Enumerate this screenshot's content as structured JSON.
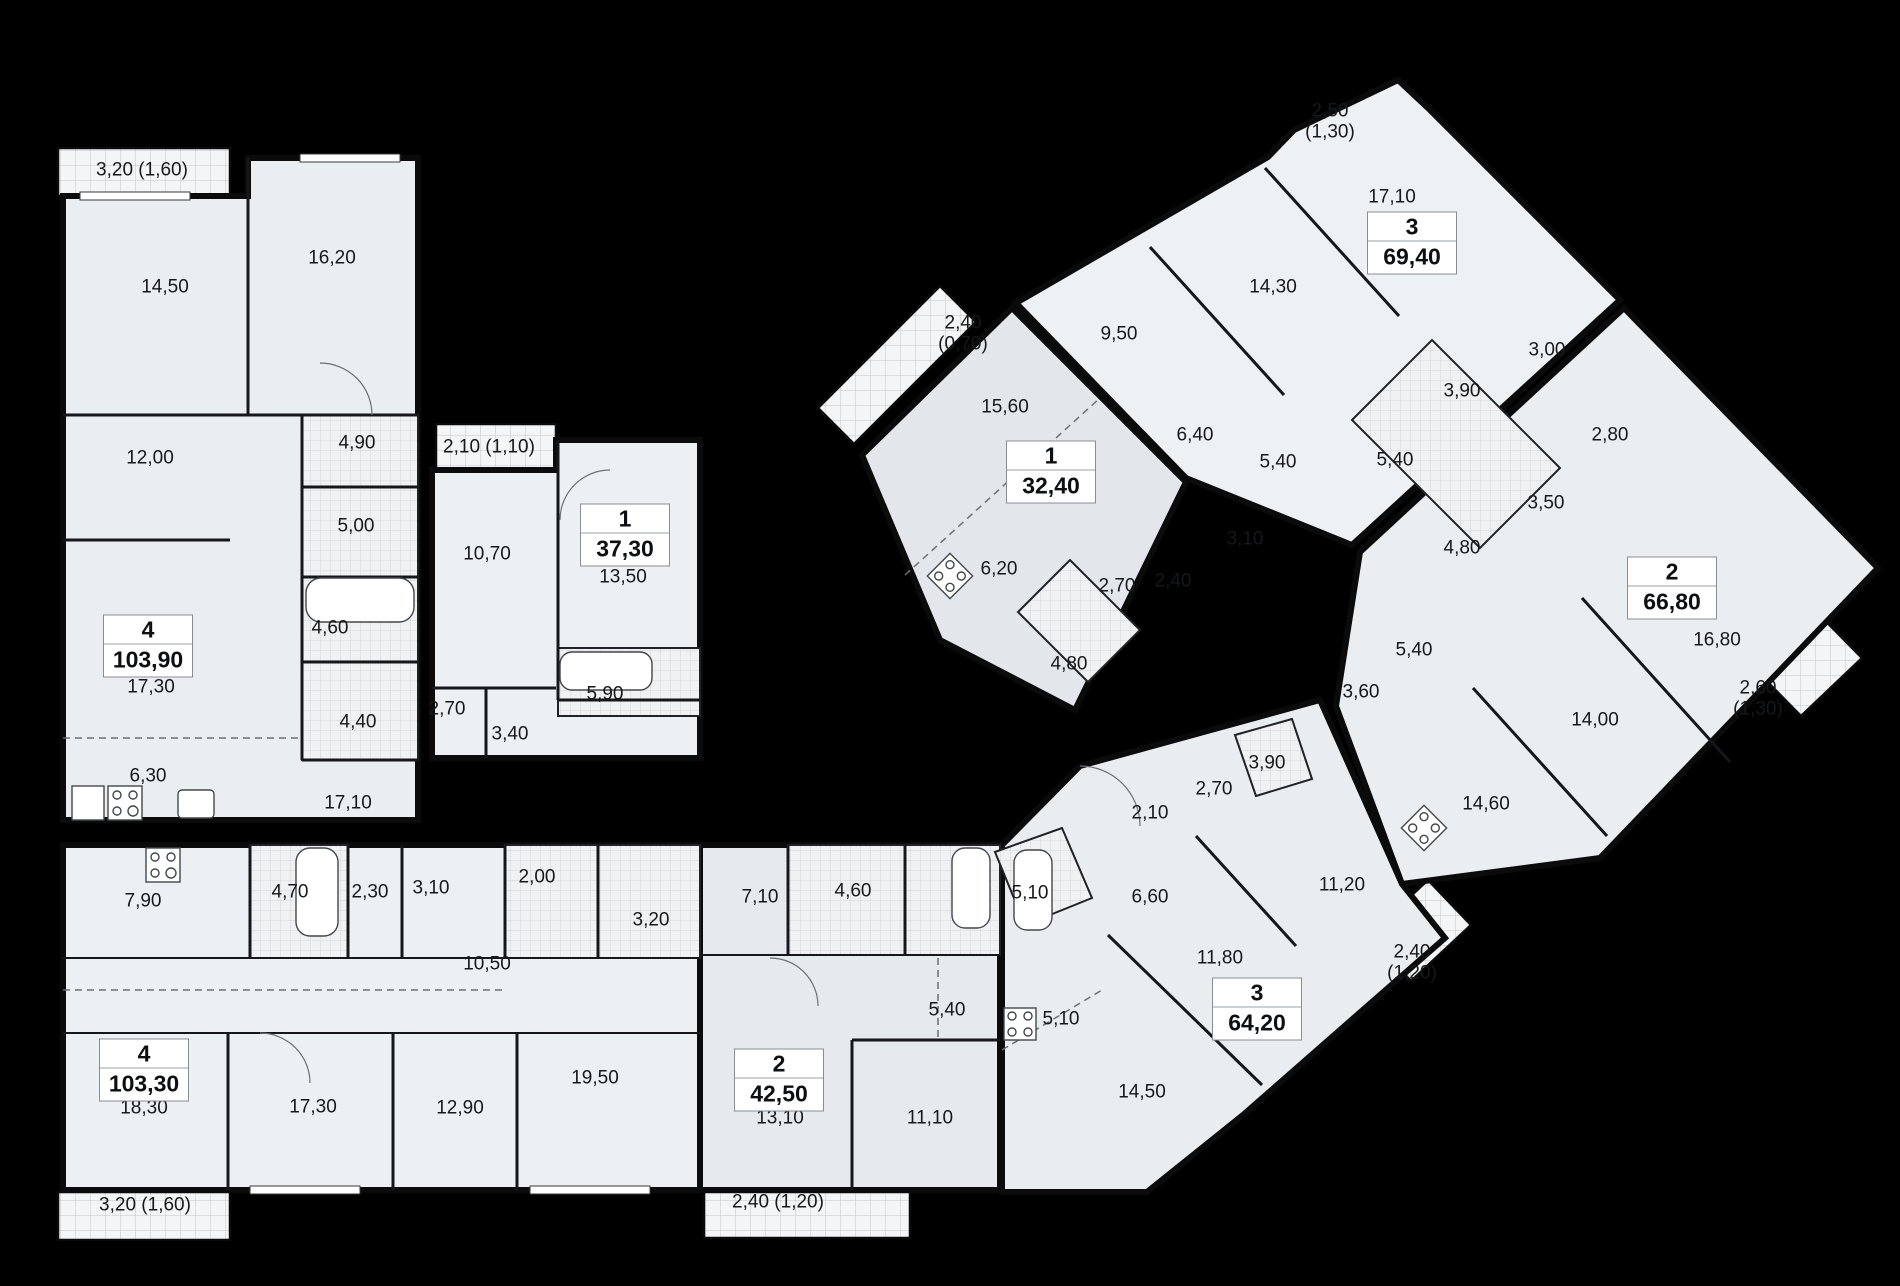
{
  "colors": {
    "background": "#000000",
    "floor_light": "#eef1f4",
    "floor_mid": "#e7ebee",
    "wall": "#0b0b0b",
    "balcony_hatch": "#f3f5f6"
  },
  "icons": [
    "stove-icon",
    "sink-icon",
    "bathtub-icon",
    "fridge-icon"
  ],
  "units": [
    {
      "id": "unit-103-90",
      "rooms_count_label": "4",
      "area_label": "103,90",
      "balcony_label": "3,20 (1,60)",
      "room_labels": [
        "14,50",
        "16,20",
        "12,00",
        "4,90",
        "5,00",
        "4,60",
        "17,30",
        "4,40",
        "6,30",
        "17,10"
      ]
    },
    {
      "id": "unit-37-30",
      "rooms_count_label": "1",
      "area_label": "37,30",
      "balcony_label": "2,10 (1,10)",
      "room_labels": [
        "10,70",
        "13,50",
        "2,70",
        "3,40",
        "5,90"
      ]
    },
    {
      "id": "unit-103-30",
      "rooms_count_label": "4",
      "area_label": "103,30",
      "balcony_label": "3,20 (1,60)",
      "room_labels": [
        "7,90",
        "4,70",
        "2,30",
        "3,10",
        "2,00",
        "3,20",
        "10,50",
        "18,30",
        "17,30",
        "12,90",
        "19,50"
      ]
    },
    {
      "id": "unit-42-50",
      "rooms_count_label": "2",
      "area_label": "42,50",
      "balcony_label": "2,40 (1,20)",
      "room_labels": [
        "7,10",
        "4,60",
        "5,40",
        "13,10",
        "11,10"
      ]
    },
    {
      "id": "unit-64-20",
      "rooms_count_label": "3",
      "area_label": "64,20",
      "balcony_label": "2,40 (1,20)",
      "room_labels": [
        "5,10",
        "2,10",
        "2,70",
        "3,90",
        "6,60",
        "11,20",
        "11,80",
        "5,10",
        "14,50"
      ]
    },
    {
      "id": "unit-66-80",
      "rooms_count_label": "2",
      "area_label": "66,80",
      "balcony_label": "2,60 (1,30)",
      "room_labels": [
        "2,80",
        "3,50",
        "4,80",
        "5,40",
        "3,60",
        "14,60",
        "14,00",
        "16,80"
      ]
    },
    {
      "id": "unit-69-40",
      "rooms_count_label": "3",
      "area_label": "69,40",
      "balcony_label": "2,50 (1,30)",
      "room_labels": [
        "17,10",
        "14,30",
        "9,50",
        "6,40",
        "5,40",
        "3,10",
        "3,90",
        "5,40",
        "3,00"
      ]
    },
    {
      "id": "unit-32-40",
      "rooms_count_label": "1",
      "area_label": "32,40",
      "balcony_label": "2,40 (0,70)",
      "room_labels": [
        "15,60",
        "6,20",
        "2,70",
        "2,40",
        "4,80"
      ]
    }
  ]
}
